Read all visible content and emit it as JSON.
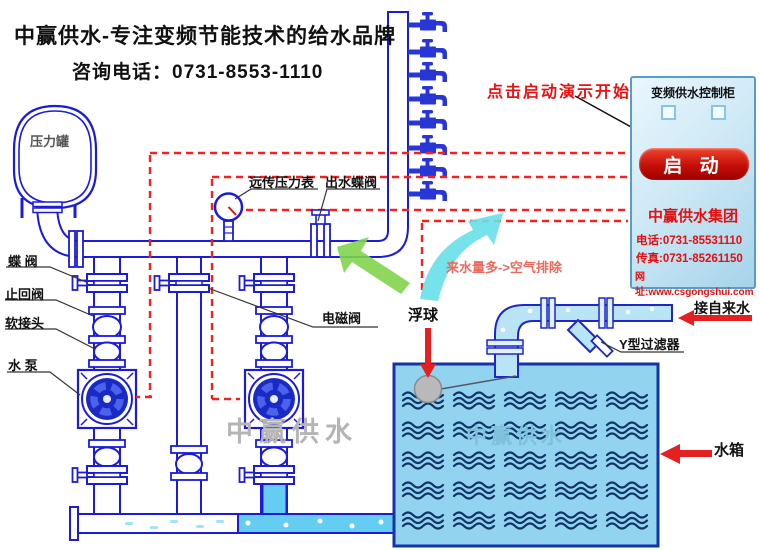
{
  "header": {
    "slogan": "中赢供水-专注变频节能技术的给水品牌",
    "hotline": "咨询电话：0731-8553-1110"
  },
  "annotations": {
    "click_start": "点击启动演示开始",
    "air_purge": "来水量多->空气排除"
  },
  "labels": {
    "pressure_tank": "压力罐",
    "butterfly_valve": "蝶 阀",
    "check_valve": "止回阀",
    "flex_joint": "软接头",
    "water_pump": "水 泵",
    "remote_gauge": "远传压力表",
    "outlet_valve": "出水蝶阀",
    "solenoid_valve": "电磁阀",
    "float_ball": "浮球",
    "tap_water": "接自来水",
    "y_filter": "Y型过滤器",
    "water_tank": "水箱"
  },
  "cabinet": {
    "title": "变频供水控制柜",
    "start_button": "启 动",
    "company": "中赢供水集团",
    "phone": "电话:0731-85531110",
    "fax": "传真:0731-85261150",
    "website": "网址:www.csgongshui.com"
  },
  "watermark": {
    "text": "中赢供水"
  },
  "colors": {
    "line_blue": "#1c1cd8",
    "water_fill": "#66cdf2",
    "tank_fill": "#92d3ef",
    "wave_blue": "#113468",
    "dashed_red": "#f32222",
    "accent_red": "#e42020",
    "green_arrow": "#82d44e",
    "cyan_arrow": "#6ae0e8"
  },
  "tank": {
    "wave_rows": 5,
    "wave_cols": 5
  }
}
